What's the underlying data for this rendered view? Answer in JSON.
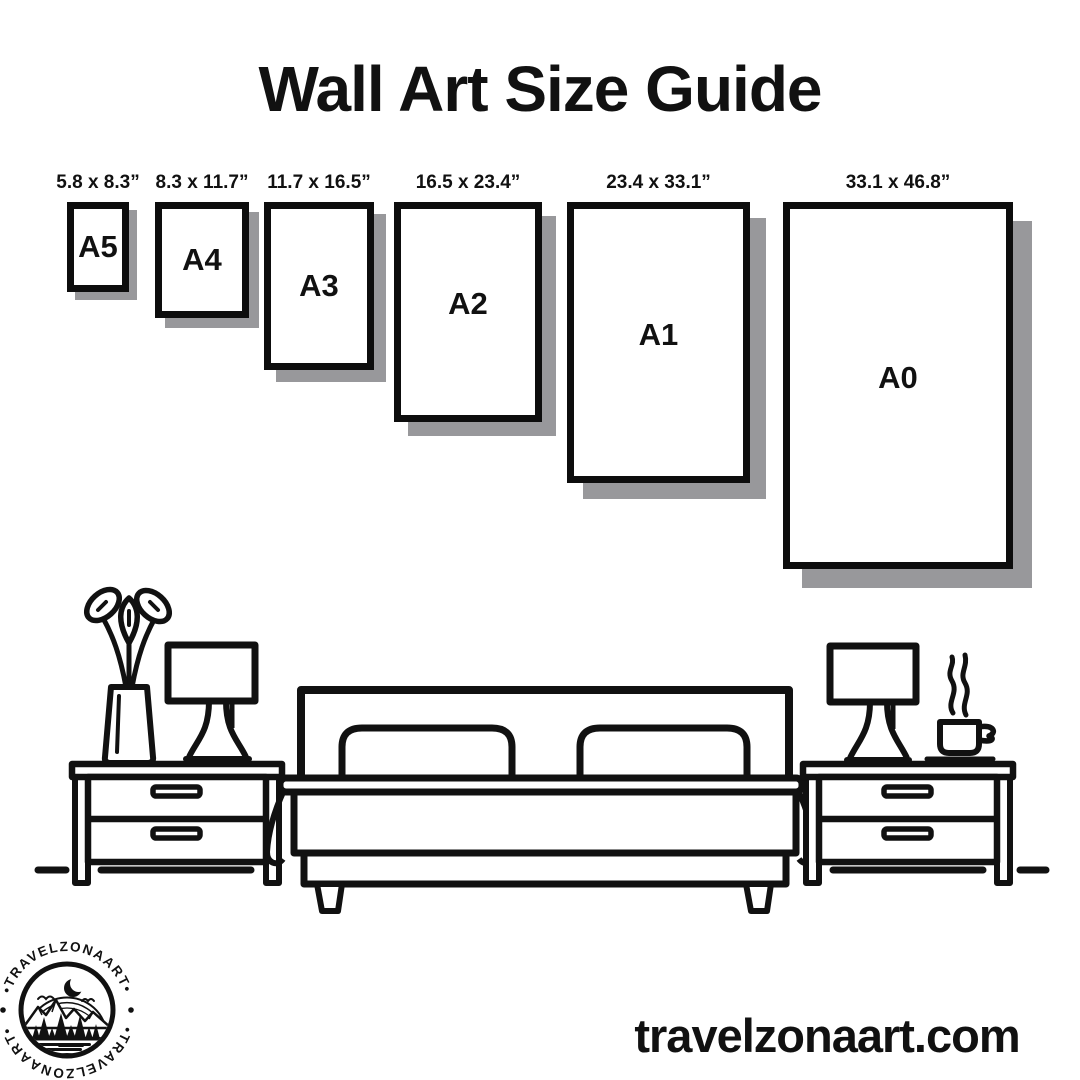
{
  "header": {
    "title": "Wall Art Size Guide"
  },
  "sizes": [
    {
      "code": "A5",
      "dimensions": "5.8 x 8.3”",
      "x": 67,
      "y": 202,
      "w": 62,
      "h": 90,
      "shadow": 8
    },
    {
      "code": "A4",
      "dimensions": "8.3 x 11.7”",
      "x": 155,
      "y": 202,
      "w": 94,
      "h": 116,
      "shadow": 10
    },
    {
      "code": "A3",
      "dimensions": "11.7 x 16.5”",
      "x": 264,
      "y": 202,
      "w": 110,
      "h": 168,
      "shadow": 12
    },
    {
      "code": "A2",
      "dimensions": "16.5 x 23.4”",
      "x": 394,
      "y": 202,
      "w": 148,
      "h": 220,
      "shadow": 14
    },
    {
      "code": "A1",
      "dimensions": "23.4 x 33.1”",
      "x": 567,
      "y": 202,
      "w": 183,
      "h": 281,
      "shadow": 16
    },
    {
      "code": "A0",
      "dimensions": "33.1 x 46.8”",
      "x": 783,
      "y": 202,
      "w": 230,
      "h": 367,
      "shadow": 19
    }
  ],
  "logo": {
    "ring_text_top": "•TRAVELZONAART•",
    "ring_text_bottom": "•TRAVELZONAART•"
  },
  "footer": {
    "website": "travelzonaart.com"
  },
  "colors": {
    "ink": "#111111",
    "frame_border": "#0d0d0d",
    "shadow": "#98989b",
    "background": "#ffffff"
  }
}
